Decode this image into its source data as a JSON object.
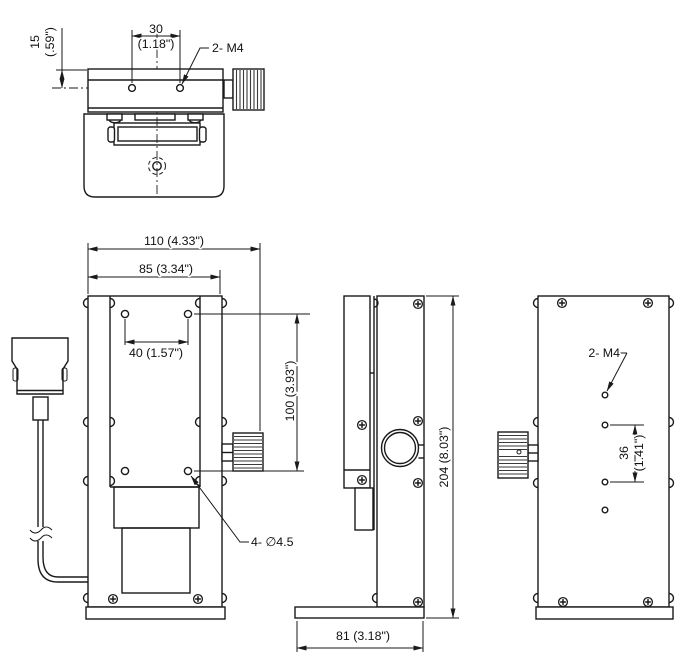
{
  "views": {
    "top": {
      "hole_spacing_mm": "30",
      "hole_spacing_in": "(1.18\")",
      "edge_offset_mm": "15",
      "edge_offset_in": "(.59\")",
      "thread_label": "2- M4"
    },
    "front": {
      "overall_width": "110 (4.33\")",
      "body_width": "85 (3.34\")",
      "hole_spacing_x": "40 (1.57\")",
      "hole_spacing_y": "100 (3.93\")",
      "hole_label": "4- ∅4.5"
    },
    "side": {
      "overall_height": "204 (8.03\")",
      "base_depth": "81 (3.18\")"
    },
    "back": {
      "thread_label": "2- M4",
      "hole_spacing_mm": "36",
      "hole_spacing_in": "(1.41\")"
    }
  },
  "colors": {
    "line": "#1a1a1a",
    "background": "#ffffff"
  }
}
